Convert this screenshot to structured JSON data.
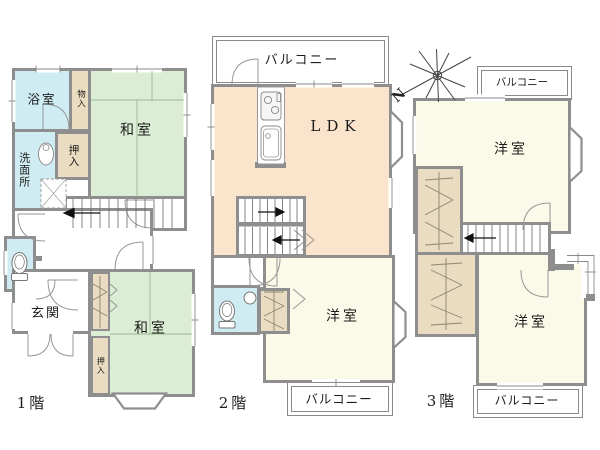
{
  "colors": {
    "wall": "#8e8e8e",
    "water": "#cfecf3",
    "tatami": "#dcedd6",
    "closet": "#e9dcc0",
    "ldk": "#fbe4cc",
    "western": "#fbfae8"
  },
  "compass": {
    "north_label": "N"
  },
  "floor1": {
    "floor_label": "1階",
    "bathroom_label": "浴室",
    "storage_label": "物入",
    "tatami_upper_label": "和室",
    "closet_upper_label": "押入",
    "washroom_label": "洗面所",
    "entrance_label": "玄関",
    "tatami_lower_label": "和室",
    "closet_lower_label": "押入"
  },
  "floor2": {
    "floor_label": "2階",
    "balcony_top_label": "バルコニー",
    "ldk_label": "LDK",
    "western_label": "洋室",
    "balcony_bottom_label": "バルコニー"
  },
  "floor3": {
    "floor_label": "3階",
    "balcony_top_label": "バルコニー",
    "western_upper_label": "洋室",
    "western_lower_label": "洋室",
    "balcony_bottom_label": "バルコニー"
  }
}
